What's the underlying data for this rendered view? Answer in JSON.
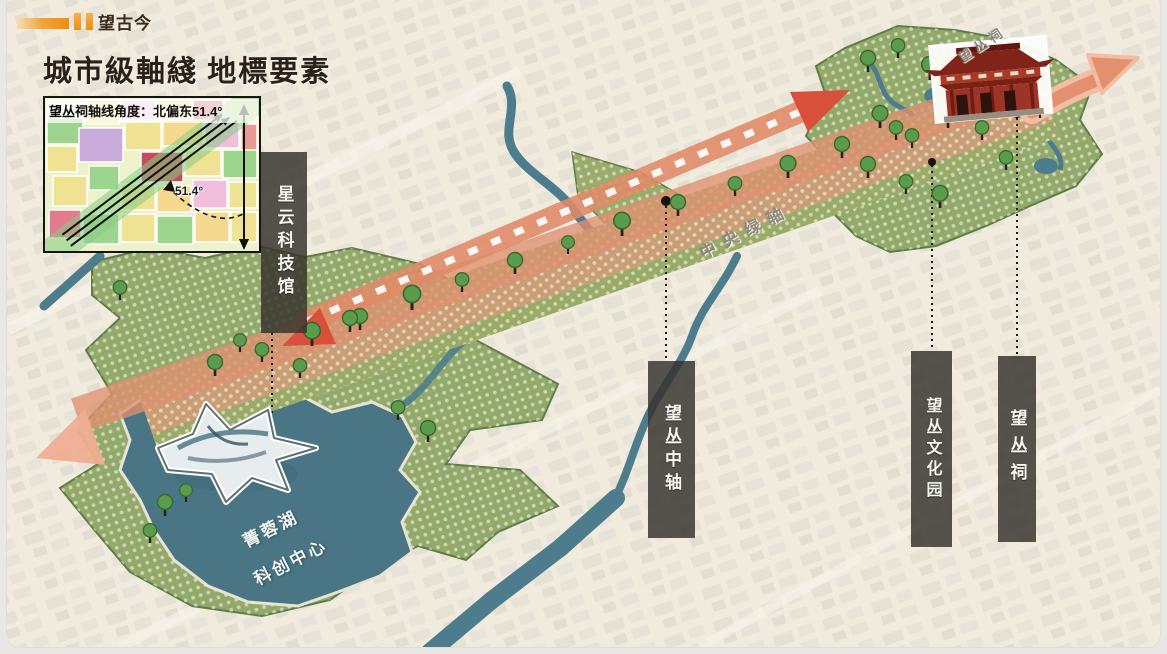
{
  "header": {
    "section_label": "望古今"
  },
  "title": "城市級軸綫 地標要素",
  "inset": {
    "caption": "望丛祠轴线角度：北偏东51.4°",
    "angle_label": "51.4°"
  },
  "landmarks": {
    "bars": [
      {
        "label": "星云科技馆"
      },
      {
        "label": "望丛中轴"
      },
      {
        "label": "望丛文化园"
      },
      {
        "label": "望丛祠"
      }
    ]
  },
  "map_labels": {
    "lake_name": "菁蓉湖",
    "lake_subtitle": "科创中心",
    "central_green_axis": "中央绿轴",
    "temple_site": "望丛祠"
  },
  "colors": {
    "accent_orange": "#ef8d12",
    "axis_salmon": "#df8f70",
    "arrow_red": "#d8503c",
    "park_green": "#93a969",
    "water_teal": "#4a7585",
    "bar_dark": "rgba(55,51,47,0.84)"
  }
}
